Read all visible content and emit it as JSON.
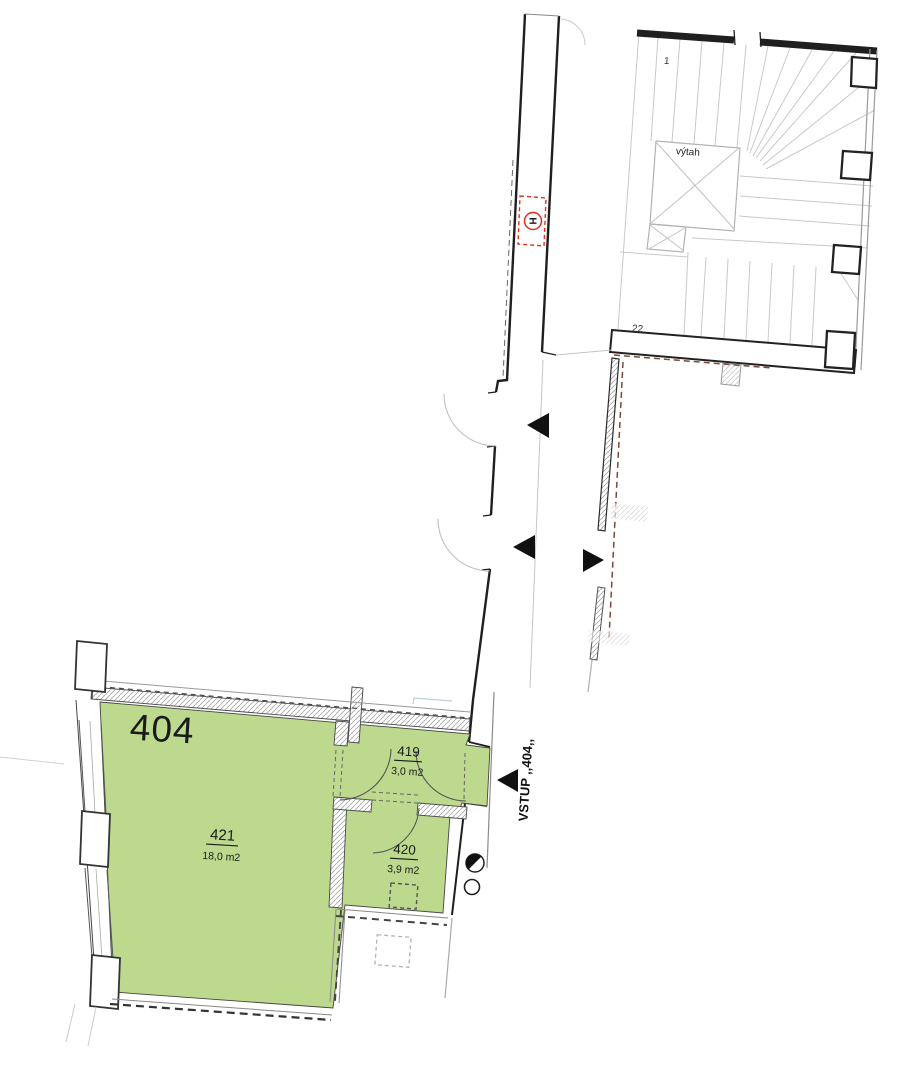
{
  "plan": {
    "apartment_label": "404",
    "entrance_label": "VSTUP ,,404,,",
    "rooms": [
      {
        "number": "421",
        "area": "18,0 m2"
      },
      {
        "number": "419",
        "area": "3,0 m2"
      },
      {
        "number": "420",
        "area": "3,9 m2"
      }
    ],
    "staircase": {
      "elevator_label": "výtah",
      "first_step": "1",
      "last_step": "22"
    },
    "hydrant": {
      "letter": "H"
    },
    "colors": {
      "room_fill": "#bcd98e",
      "highlight_red": "#ee1c0c",
      "hydrant_red": "#e0301e",
      "wall_dark": "#1f1f1f",
      "stair_gray": "#c9c9c9",
      "dash_brown": "#7b4a39"
    }
  }
}
